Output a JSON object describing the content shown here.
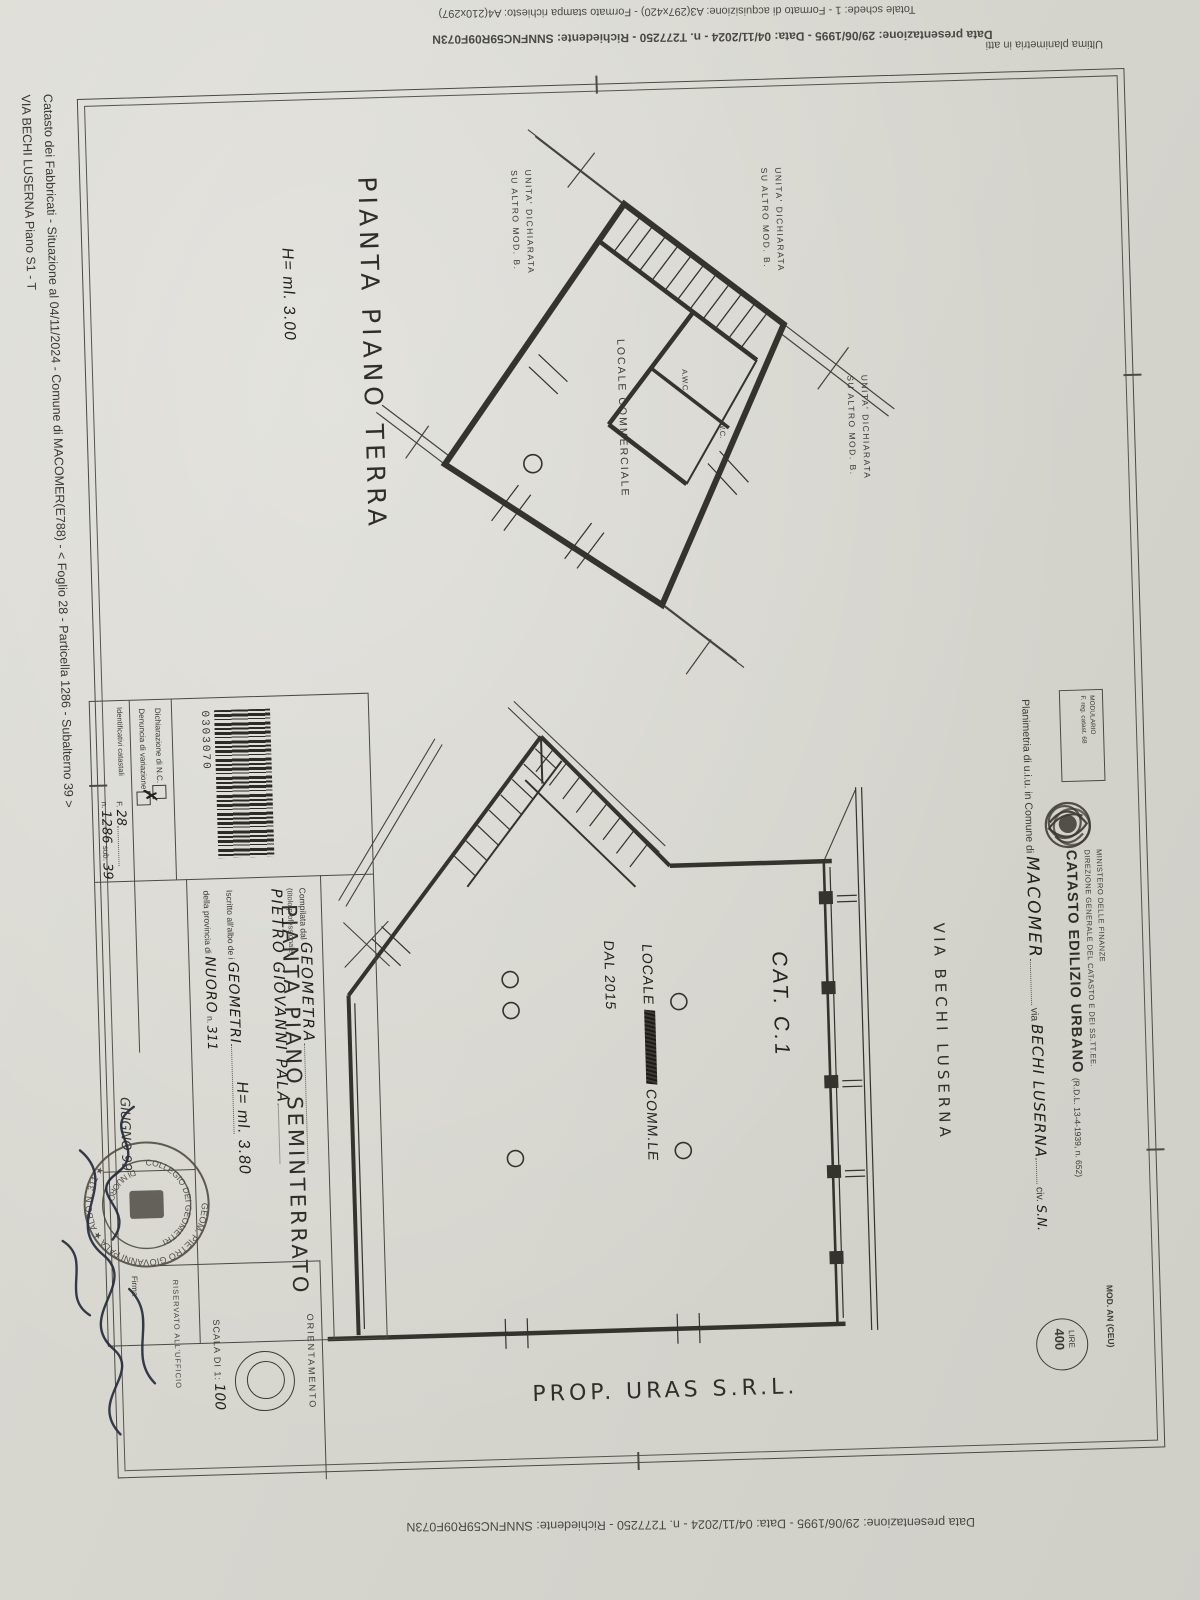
{
  "margin_notes": {
    "top_format": "Totale schede: 1 - Formato di acquisizione: A3(297x420)  - Formato stampa richiesto: A4(210x297)",
    "top_presentazione": "Data presentazione: 29/06/1995 - Data: 04/11/2024 - n. T277250 - Richiedente: SNNFNC59R09F073N",
    "top_ultima": "Ultima planimetria in atti",
    "bottom_presentazione": "Data presentazione: 29/06/1995 - Data: 04/11/2024 - n. T277250 - Richiedente: SNNFNC59R09F073N",
    "side_catasto": "Catasto dei Fabbricati - Situazione al 04/11/2024 - Comune di MACOMER(E788) - < Foglio 28 - Particella 1286 - Subalterno 39 >",
    "side_indirizzo": "VIA BECHI LUSERNA Piano S1 - T"
  },
  "header": {
    "modulario": "MODULARIO",
    "modulario_sub": "F. reg. catast. 68",
    "mod_an": "MOD. AN (CEU)",
    "lire_label": "LIRE",
    "lire_value": "400",
    "ministero": "MINISTERO DELLE FINANZE",
    "direzione": "DIREZIONE GENERALE DEL CATASTO E DEI SS.TT.EE.",
    "catasto_title": "CATASTO EDILIZIO URBANO",
    "catasto_ref": "(R.D.L. 13-4-1939, n. 652)",
    "planimetria_label": "Planimetria di u.i.u. in Comune di",
    "comune_value": "MACOMER",
    "via_label": "via",
    "via_value": "BECHI  LUSERNA",
    "civ_label": "civ.",
    "civ_value": "S.N."
  },
  "plans": {
    "terra": {
      "title": "PIANTA  PIANO  TERRA",
      "height_note": "H= ml. 3.00",
      "labels": {
        "unita_line1": "UNITA'  DICHIARATA",
        "unita_line2": "SU  ALTRO  MOD. B.",
        "locale": "LOCALE  COMMERCIALE",
        "awc": "A.W.C.",
        "wc": "W.C."
      }
    },
    "seminterrato": {
      "title": "PIANTA  PIANO  SEMINTERRATO",
      "height_note": "H= ml. 3.80",
      "labels": {
        "cat": "CAT. C.1",
        "locale_line1": "LOCALE",
        "locale_line2": "COMM.LE",
        "locale_line3": "DAL 2015",
        "via": "VIA  BECHI  LUSERNA",
        "prop": "PROP. URAS  S.R.L."
      }
    }
  },
  "form": {
    "dichiarazione": "Dichiarazione di N.C.",
    "denuncia": "Denuncia di  variazione",
    "identificativi": "Identificativi catastali",
    "foglio_label": "F.",
    "foglio_value": "28",
    "num_label": "n.",
    "num_value": "1286",
    "sub_label": "sub.",
    "sub_value": "39",
    "barcode_number": "0303070",
    "compilata_label": "Compilata dal",
    "compilata_value": "GEOMETRA",
    "titolo_hint": "(titolo professionale)",
    "nome_value": "PIETRO  GIOVANNI  PALA",
    "iscritto_label": "Iscritto all'albo de i",
    "albo_value": "GEOMETRI",
    "provincia_label": "della provincia di",
    "provincia_value": "NUORO",
    "albo_num_label": "n.",
    "albo_num_value": "311",
    "data_value": "GIUGNO 99",
    "firma_label": "Firma",
    "riservato": "RISERVATO ALL'UFFICIO",
    "scala_label": "SCALA DI 1:",
    "scala_value": "100",
    "orientamento": "ORIENTAMENTO"
  },
  "stamp": {
    "outer_ring": "GEOM. PIETRO GIOVANNI PALA ★ ALBO N. 311 ★",
    "inner_top": "COLLEGIO DEI GEOMETRI",
    "inner_bottom": "DI NUORO"
  }
}
